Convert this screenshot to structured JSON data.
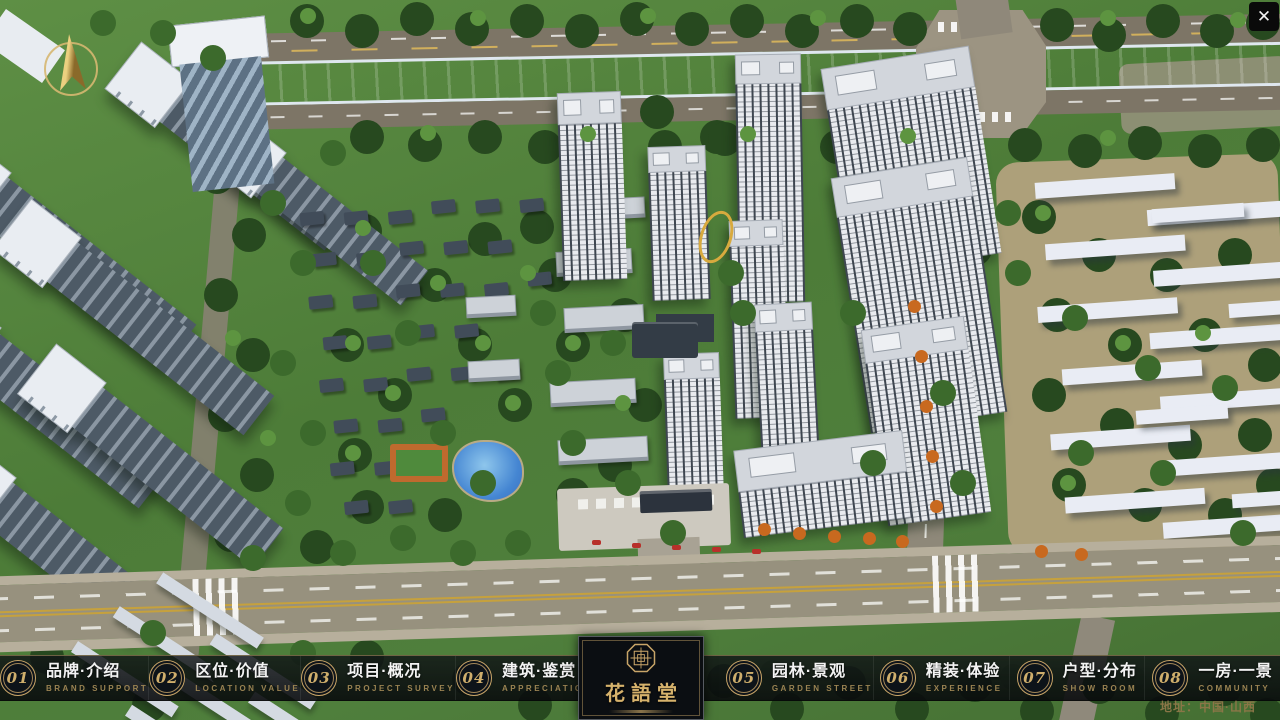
{
  "window": {
    "close_glyph": "✕"
  },
  "logo": {
    "name": "花語堂"
  },
  "footer": {
    "address": "地址：中国·山西"
  },
  "menu": {
    "items": [
      {
        "num": "01",
        "title": "品牌·介绍",
        "subtitle": "BRAND SUPPORT"
      },
      {
        "num": "02",
        "title": "区位·价值",
        "subtitle": "LOCATION VALUE"
      },
      {
        "num": "03",
        "title": "项目·概况",
        "subtitle": "PROJECT SURVEY"
      },
      {
        "num": "04",
        "title": "建筑·鉴赏",
        "subtitle": "APPRECIATION"
      },
      {
        "num": "05",
        "title": "园林·景观",
        "subtitle": "GARDEN STREET"
      },
      {
        "num": "06",
        "title": "精装·体验",
        "subtitle": "EXPERIENCE"
      },
      {
        "num": "07",
        "title": "户型·分布",
        "subtitle": "SHOW ROOM"
      },
      {
        "num": "08",
        "title": "一房·一景",
        "subtitle": "COMMUNITY"
      }
    ]
  },
  "colors": {
    "gold": "#c9a568",
    "river": "#2d53b6",
    "grass": "#578743",
    "road": "#98927f",
    "panel": "#0b0e12"
  }
}
